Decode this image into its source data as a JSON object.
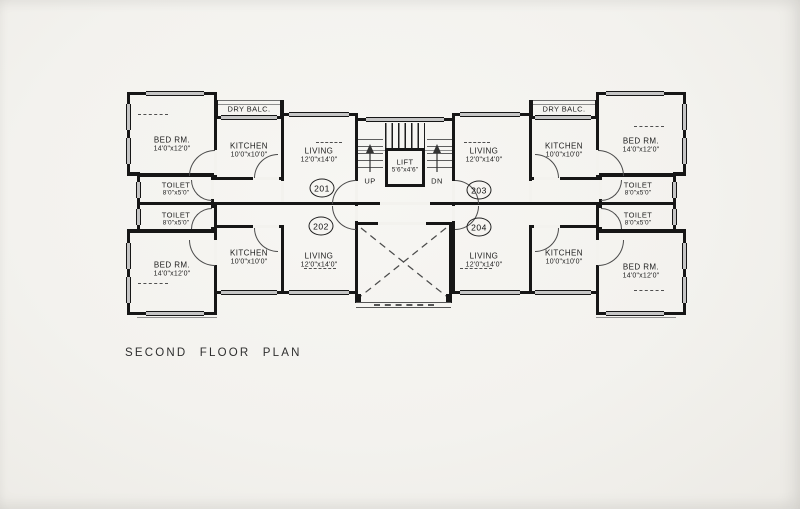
{
  "title": "SECOND FLOOR PLAN",
  "colors": {
    "wall": "#161616",
    "paper": "#f3f2ee",
    "window_fill": "#c6c6c6",
    "thin_line": "#555555",
    "text": "#1c1c1c"
  },
  "room_types": {
    "bedroom": {
      "label": "BED RM.",
      "dims": "14'0\"x12'0\""
    },
    "kitchen": {
      "label": "KITCHEN",
      "dims": "10'0\"x10'0\""
    },
    "living": {
      "label": "LIVING",
      "dims": "12'0\"x14'0\""
    },
    "toilet": {
      "label": "TOILET",
      "dims": "8'0\"x5'0\""
    },
    "dry_balcony": {
      "label": "DRY BALC."
    },
    "lift": {
      "label": "LIFT",
      "dims": "5'6\"x4'6\""
    }
  },
  "units": {
    "u201": {
      "number": "201"
    },
    "u202": {
      "number": "202"
    },
    "u203": {
      "number": "203"
    },
    "u204": {
      "number": "204"
    }
  },
  "stairs": {
    "up": "UP",
    "down": "DN"
  }
}
